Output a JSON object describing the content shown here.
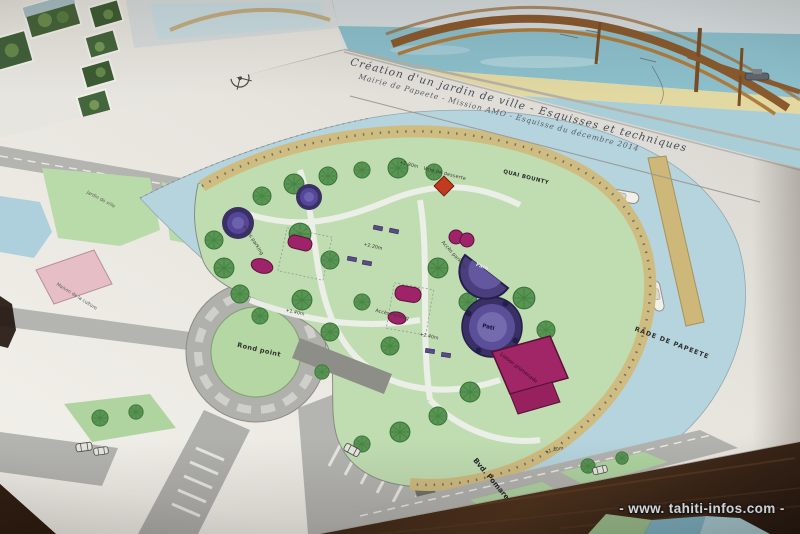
{
  "photo": {
    "description": "Photo of architectural landscape plans for the Papeete waterfront garden laid on a wooden table",
    "watermark": "- www. tahiti-infos.com -"
  },
  "plan": {
    "title_line1": "Création d'un jardin de ville - Esquisses et techniques",
    "title_line2": "Mairie de Papeete - Mission AMO - Esquisse du décembre 2014",
    "labels": {
      "quai_bounty": "QUAI BOUNTY",
      "rade_de_papeete": "RADE DE PAPEETE",
      "voie_de_desserte": "Voie de desserte",
      "plus_180": "+1.80m",
      "plus_220": "+2.20m",
      "plus_240": "+2.40m",
      "plus_140_a": "+1.40m",
      "plus_140_b": "+1.40m",
      "bvd_pomare": "Bvd. Pomare",
      "rond_point": "Rond point",
      "acces_parking_1": "accès parking",
      "acces_parking_2": "Accès parking",
      "acces_parking_3": "Accès Parking",
      "fare": "Fare",
      "pati": "Pati",
      "liaison_promenade": "Liaison promenade",
      "maison_culture": "Maison de la culture",
      "jardin_ville": "Jardin de ville"
    },
    "icons": {
      "compass": "compass-rose",
      "tree": "tree-symbol",
      "car": "car-symbol",
      "boat": "boat-symbol"
    },
    "colors": {
      "paper": "#ece9e3",
      "harbor_water": "#b5d4de",
      "lagoon_rendering": "#8cc0cc",
      "park_green": "#c0ddb1",
      "promenade_tan": "#cfbc80",
      "road_gray": "#b2b2ae",
      "pavilion_purple": "#4a3e7d",
      "play_magenta": "#a12667",
      "market_pink": "#e6bec6",
      "wood_table": "#33211a"
    }
  }
}
